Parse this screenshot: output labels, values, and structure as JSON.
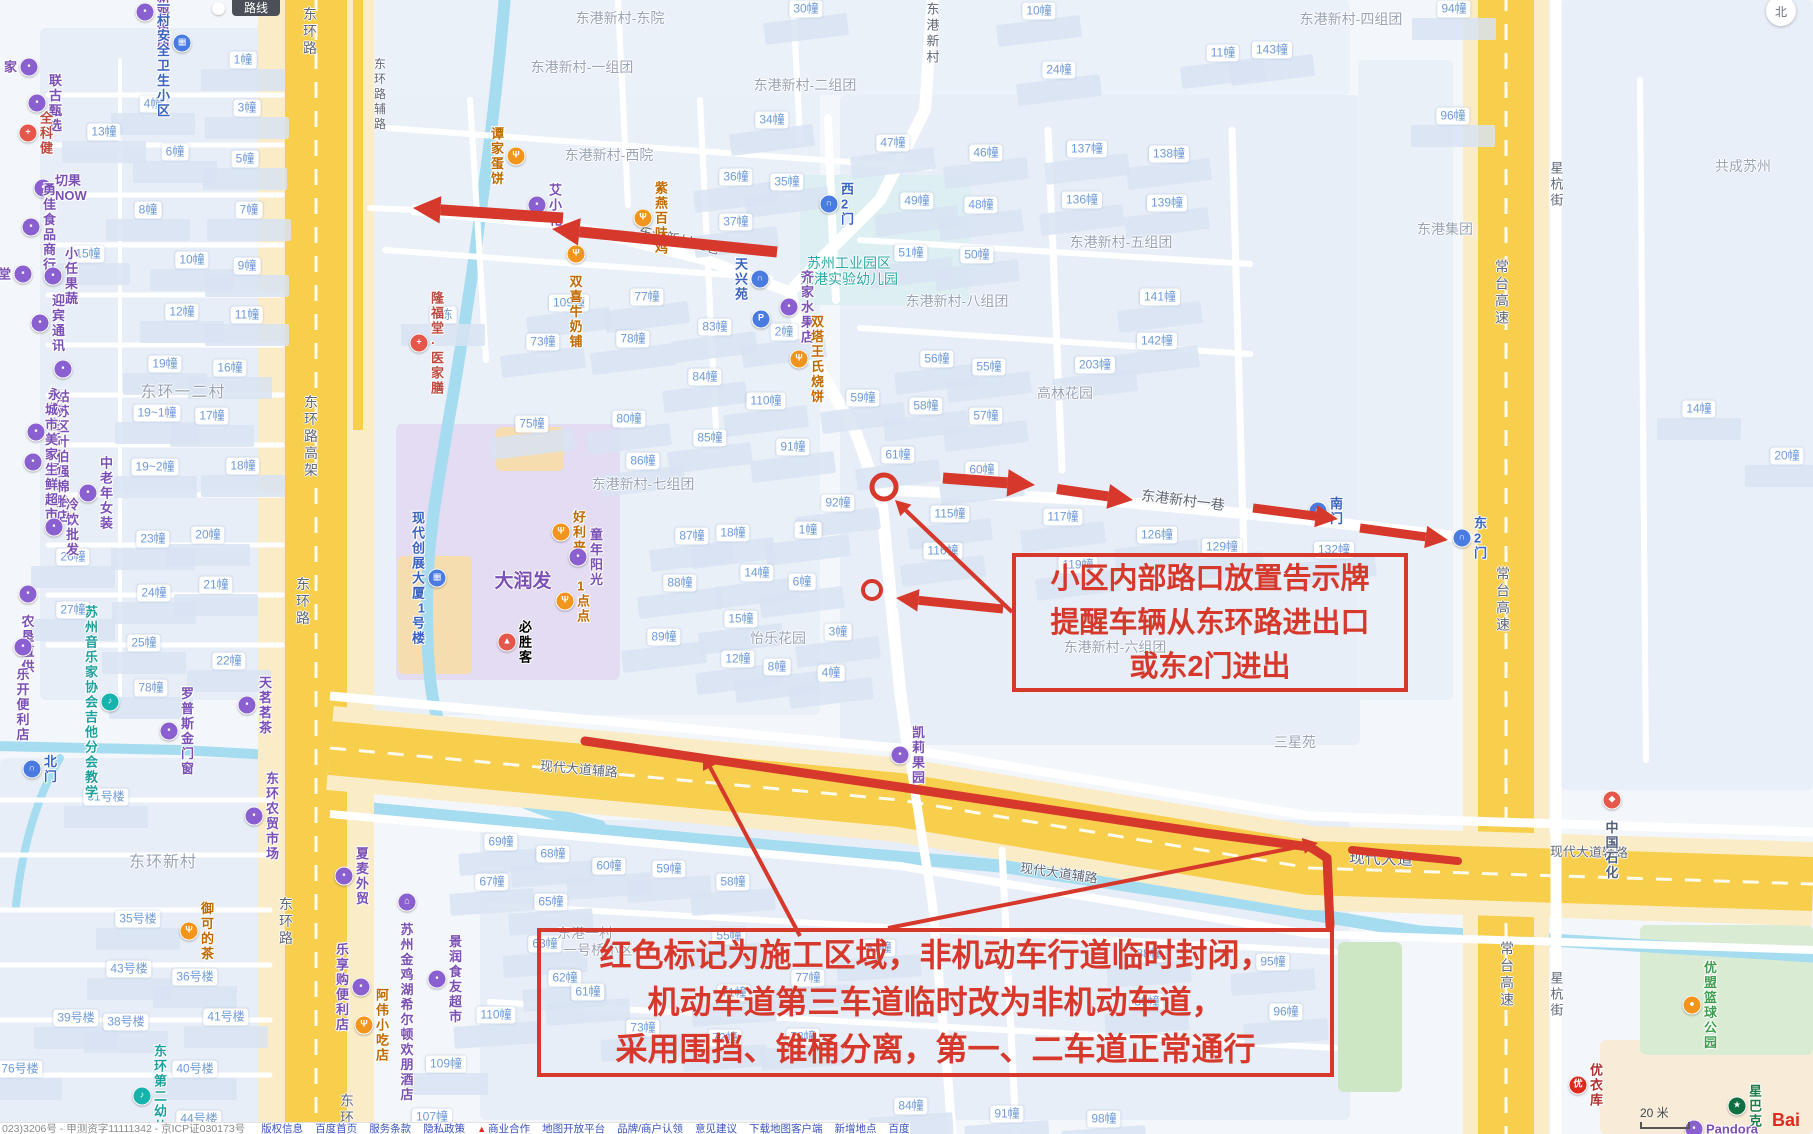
{
  "annotations": {
    "color": "#d6382b",
    "box1": {
      "lines": [
        "小区内部路口放置告示牌",
        "提醒车辆从东环路进出口",
        "或东2门进出"
      ]
    },
    "box2": {
      "lines": [
        "红色标记为施工区域，非机动车行道临时封闭，",
        "机动车道第三车道临时改为非机动车道，",
        "采用围挡、锥桶分离，第一、二车道正常通行"
      ]
    }
  },
  "controls": {
    "route_button": "路线",
    "compass": "北",
    "scale": "20 米",
    "logo": "Bai"
  },
  "footer": {
    "icp": "023)3206号 - 甲测资字11111342 - 京ICP证030173号",
    "links": [
      "版权信息",
      "百度首页",
      "服务条款",
      "隐私政策",
      "商业合作",
      "地图开放平台",
      "品牌/商户认领",
      "意见建议",
      "下载地图客户端",
      "新增地点",
      "百度营销"
    ]
  },
  "map": {
    "buildings": [
      [
        243,
        60,
        "1幢"
      ],
      [
        153,
        104,
        "4幢"
      ],
      [
        247,
        108,
        "3幢"
      ],
      [
        104,
        132,
        "13幢"
      ],
      [
        175,
        152,
        "6幢"
      ],
      [
        245,
        159,
        "5幢"
      ],
      [
        148,
        210,
        "8幢"
      ],
      [
        249,
        210,
        "7幢"
      ],
      [
        88,
        254,
        "15幢"
      ],
      [
        192,
        260,
        "10幢"
      ],
      [
        247,
        266,
        "9幢"
      ],
      [
        182,
        312,
        "12幢"
      ],
      [
        247,
        315,
        "11幢"
      ],
      [
        165,
        364,
        "19幢"
      ],
      [
        230,
        368,
        "16幢"
      ],
      [
        157,
        413,
        "19~1幢"
      ],
      [
        212,
        416,
        "17幢"
      ],
      [
        155,
        467,
        "19~2幢"
      ],
      [
        243,
        466,
        "18幢"
      ],
      [
        153,
        539,
        "23幢"
      ],
      [
        208,
        535,
        "20幢"
      ],
      [
        73,
        557,
        "26幢"
      ],
      [
        216,
        585,
        "21幢"
      ],
      [
        154,
        593,
        "24幢"
      ],
      [
        73,
        610,
        "27幢"
      ],
      [
        144,
        643,
        "25幢"
      ],
      [
        229,
        661,
        "22幢"
      ],
      [
        151,
        688,
        "78幢"
      ],
      [
        106,
        797,
        "31号楼"
      ],
      [
        138,
        919,
        "35号楼"
      ],
      [
        129,
        969,
        "43号楼"
      ],
      [
        195,
        977,
        "36号楼"
      ],
      [
        76,
        1018,
        "39号楼"
      ],
      [
        126,
        1022,
        "38号楼"
      ],
      [
        226,
        1017,
        "41号楼"
      ],
      [
        20,
        1069,
        "76号楼"
      ],
      [
        195,
        1069,
        "40号楼"
      ],
      [
        199,
        1119,
        "44号楼"
      ],
      [
        446,
        1064,
        "109幢"
      ],
      [
        432,
        1117,
        "107幢"
      ],
      [
        443,
        315,
        "1栋"
      ],
      [
        532,
        424,
        "75幢"
      ],
      [
        629,
        419,
        "80幢"
      ],
      [
        710,
        438,
        "85幢"
      ],
      [
        643,
        461,
        "86幢"
      ],
      [
        569,
        303,
        "109幢"
      ],
      [
        543,
        342,
        "73幢"
      ],
      [
        633,
        339,
        "78幢"
      ],
      [
        647,
        297,
        "77幢"
      ],
      [
        715,
        327,
        "83幢"
      ],
      [
        772,
        120,
        "34幢"
      ],
      [
        736,
        177,
        "36幢"
      ],
      [
        787,
        182,
        "35幢"
      ],
      [
        736,
        222,
        "37幢"
      ],
      [
        692,
        536,
        "87幢"
      ],
      [
        733,
        533,
        "18幢"
      ],
      [
        808,
        530,
        "1幢"
      ],
      [
        757,
        573,
        "14幢"
      ],
      [
        802,
        582,
        "6幢"
      ],
      [
        680,
        583,
        "88幢"
      ],
      [
        741,
        619,
        "15幢"
      ],
      [
        664,
        637,
        "89幢"
      ],
      [
        738,
        659,
        "12幢"
      ],
      [
        777,
        667,
        "8幢"
      ],
      [
        831,
        673,
        "4幢"
      ],
      [
        838,
        632,
        "3幢"
      ],
      [
        793,
        447,
        "91幢"
      ],
      [
        838,
        503,
        "92幢"
      ],
      [
        705,
        377,
        "84幢"
      ],
      [
        766,
        401,
        "110幢"
      ],
      [
        784,
        332,
        "2幢"
      ],
      [
        893,
        143,
        "47幢"
      ],
      [
        986,
        153,
        "46幢"
      ],
      [
        917,
        201,
        "49幢"
      ],
      [
        981,
        205,
        "48幢"
      ],
      [
        911,
        253,
        "51幢"
      ],
      [
        977,
        255,
        "50幢"
      ],
      [
        937,
        359,
        "56幢"
      ],
      [
        989,
        367,
        "55幢"
      ],
      [
        863,
        398,
        "59幢"
      ],
      [
        926,
        406,
        "58幢"
      ],
      [
        986,
        416,
        "57幢"
      ],
      [
        898,
        455,
        "61幢"
      ],
      [
        982,
        470,
        "60幢"
      ],
      [
        1087,
        149,
        "137幢"
      ],
      [
        1169,
        154,
        "138幢"
      ],
      [
        1082,
        200,
        "136幢"
      ],
      [
        1167,
        203,
        "139幢"
      ],
      [
        1160,
        297,
        "141幢"
      ],
      [
        1157,
        341,
        "142幢"
      ],
      [
        1095,
        365,
        "203幢"
      ],
      [
        950,
        514,
        "115幢"
      ],
      [
        1063,
        517,
        "117幢"
      ],
      [
        943,
        551,
        "116幢"
      ],
      [
        1157,
        535,
        "126幢"
      ],
      [
        1222,
        547,
        "129幢"
      ],
      [
        1078,
        565,
        "119幢"
      ],
      [
        1334,
        550,
        "132幢"
      ],
      [
        806,
        9,
        "30幢"
      ],
      [
        1039,
        11,
        "10幢"
      ],
      [
        1059,
        70,
        "24幢"
      ],
      [
        1223,
        53,
        "11幢"
      ],
      [
        1272,
        50,
        "143幢"
      ],
      [
        1454,
        9,
        "94幢"
      ],
      [
        1453,
        116,
        "96幢"
      ],
      [
        1699,
        409,
        "14幢"
      ],
      [
        1787,
        456,
        "20幢"
      ],
      [
        501,
        842,
        "69幢"
      ],
      [
        553,
        854,
        "68幢"
      ],
      [
        609,
        866,
        "60幢"
      ],
      [
        669,
        869,
        "59幢"
      ],
      [
        733,
        882,
        "58幢"
      ],
      [
        492,
        882,
        "67幢"
      ],
      [
        551,
        902,
        "65幢"
      ],
      [
        545,
        944,
        "63幢"
      ],
      [
        729,
        936,
        "55幢"
      ],
      [
        879,
        948,
        "81幢"
      ],
      [
        565,
        978,
        "62幢"
      ],
      [
        808,
        978,
        "77幢"
      ],
      [
        588,
        992,
        "61幢"
      ],
      [
        734,
        993,
        "71幢"
      ],
      [
        496,
        1015,
        "110幢"
      ],
      [
        643,
        1028,
        "73幢"
      ],
      [
        725,
        1038,
        "72幢"
      ],
      [
        803,
        1037,
        "78幢"
      ],
      [
        1149,
        954,
        "88幢"
      ],
      [
        1273,
        962,
        "95幢"
      ],
      [
        1147,
        1002,
        "89幢"
      ],
      [
        1286,
        1012,
        "96幢"
      ],
      [
        911,
        1106,
        "84幢"
      ],
      [
        1007,
        1114,
        "91幢"
      ],
      [
        1104,
        1119,
        "98幢"
      ]
    ],
    "areas": [
      [
        609,
        155,
        "东港新村-西院",
        ""
      ],
      [
        620,
        18,
        "东港新村-东院",
        ""
      ],
      [
        582,
        67,
        "东港新村-一组团",
        ""
      ],
      [
        805,
        85,
        "东港新村-二组团",
        ""
      ],
      [
        957,
        301,
        "东港新村-八组团",
        ""
      ],
      [
        1121,
        242,
        "东港新村-五组团",
        ""
      ],
      [
        1351,
        19,
        "东港新村-四组团",
        ""
      ],
      [
        643,
        484,
        "东港新村-七组团",
        ""
      ],
      [
        1115,
        647,
        "东港新村-六组团",
        ""
      ],
      [
        183,
        393,
        "东环一二村",
        "big"
      ],
      [
        163,
        863,
        "东环新村",
        "big"
      ],
      [
        585,
        933,
        "东港一村",
        ""
      ],
      [
        598,
        950,
        "一号桥小区",
        ""
      ],
      [
        778,
        638,
        "怡乐花园",
        ""
      ],
      [
        1065,
        393,
        "高林花园",
        ""
      ],
      [
        1295,
        742,
        "三星苑",
        ""
      ],
      [
        1445,
        229,
        "东港集团",
        ""
      ],
      [
        1743,
        166,
        "共成苏州",
        ""
      ],
      [
        849,
        271,
        "苏州工业园区\n东港实验幼儿园",
        "edu"
      ],
      [
        523,
        582,
        "大润发",
        "mall"
      ]
    ],
    "roadLabels": [
      {
        "x": 310,
        "y": 32,
        "t": "东环路",
        "v": 1
      },
      {
        "x": 380,
        "y": 95,
        "t": "东环路辅路",
        "v": 1,
        "fs": 12
      },
      {
        "x": 311,
        "y": 437,
        "t": "东环路高架",
        "v": 1
      },
      {
        "x": 303,
        "y": 602,
        "t": "东环路",
        "v": 1
      },
      {
        "x": 286,
        "y": 922,
        "t": "东环路",
        "v": 1
      },
      {
        "x": 347,
        "y": 1110,
        "t": "东环",
        "v": 1
      },
      {
        "x": 1502,
        "y": 293,
        "t": "常台高速",
        "v": 1
      },
      {
        "x": 1503,
        "y": 600,
        "t": "常台高速",
        "v": 1
      },
      {
        "x": 1507,
        "y": 975,
        "t": "常台高速",
        "v": 1
      },
      {
        "x": 1556,
        "y": 185,
        "t": "星杭街",
        "v": 1,
        "fs": 13
      },
      {
        "x": 1556,
        "y": 995,
        "t": "星杭街",
        "v": 1,
        "fs": 13
      },
      {
        "x": 932,
        "y": 34,
        "t": "东港新村",
        "v": 1,
        "fs": 13
      },
      {
        "x": 679,
        "y": 240,
        "t": "东港新村二巷",
        "r": 13
      },
      {
        "x": 1183,
        "y": 500,
        "t": "东港新村一巷",
        "r": 7
      },
      {
        "x": 579,
        "y": 768,
        "t": "现代大道辅路",
        "r": 5,
        "fs": 13
      },
      {
        "x": 1059,
        "y": 872,
        "t": "现代大道辅路",
        "r": 8,
        "fs": 13
      },
      {
        "x": 1589,
        "y": 851,
        "t": "现代大道辅路",
        "r": 1,
        "fs": 13
      },
      {
        "x": 1381,
        "y": 857,
        "t": "现代大道",
        "r": 2,
        "fs": 16
      }
    ],
    "pois": [
      {
        "x": 145,
        "y": 12,
        "t": "建新鸡蛋店",
        "c": "shop"
      },
      {
        "x": 182,
        "y": 43,
        "t": "东环一村安全\n卫生小区",
        "c": "gov",
        "s": "left"
      },
      {
        "x": 29,
        "y": 67,
        "t": "家",
        "c": "shop",
        "s": "left"
      },
      {
        "x": 37,
        "y": 103,
        "t": "联古甄选",
        "c": "shop"
      },
      {
        "x": 28,
        "y": 133,
        "t": "全科健",
        "c": "med"
      },
      {
        "x": 43,
        "y": 188,
        "t": "切果NOW",
        "c": "shop"
      },
      {
        "x": 31,
        "y": 227,
        "t": "勇佳食品商行",
        "c": "shop"
      },
      {
        "x": 23,
        "y": 274,
        "t": "堂",
        "c": "shop",
        "s": "left"
      },
      {
        "x": 53,
        "y": 276,
        "t": "小任果蔬",
        "c": "shop"
      },
      {
        "x": 40,
        "y": 323,
        "t": "迎宾通讯",
        "c": "shop"
      },
      {
        "x": 63,
        "y": 369,
        "t": "姑苏区叶\n伯强棉胎店",
        "c": "shop",
        "s": "below"
      },
      {
        "x": 36,
        "y": 432,
        "t": "永林生活广场",
        "c": "shop"
      },
      {
        "x": 33,
        "y": 462,
        "t": "城市美家\n生鲜超市",
        "c": "shop"
      },
      {
        "x": 88,
        "y": 493,
        "t": "中老年女装",
        "c": "shop"
      },
      {
        "x": 54,
        "y": 527,
        "t": "冷饮批发",
        "c": "shop"
      },
      {
        "x": 28,
        "y": 594,
        "t": "农垦直供",
        "c": "shop",
        "s": "below"
      },
      {
        "x": 23,
        "y": 647,
        "t": "乐开便利店",
        "c": "shop",
        "s": "below"
      },
      {
        "x": 110,
        "y": 702,
        "t": "苏州音乐家协会\n吉他分会教学",
        "c": "edu",
        "s": "left"
      },
      {
        "x": 247,
        "y": 705,
        "t": "天茗茗茶",
        "c": "shop"
      },
      {
        "x": 169,
        "y": 731,
        "t": "罗普斯金门窗",
        "c": "shop"
      },
      {
        "x": 32,
        "y": 769,
        "t": "北门",
        "c": "gate"
      },
      {
        "x": 254,
        "y": 816,
        "t": "东环农贸市场",
        "c": "shop"
      },
      {
        "x": 344,
        "y": 876,
        "t": "夏麦外贸",
        "c": "shop"
      },
      {
        "x": 189,
        "y": 931,
        "t": "御可的茶",
        "c": "food"
      },
      {
        "x": 407,
        "y": 902,
        "t": "苏州金鸡湖希尔顿\n欢朋酒店",
        "c": "hotel",
        "s": "below"
      },
      {
        "x": 437,
        "y": 979,
        "t": "景润食友超市",
        "c": "shop"
      },
      {
        "x": 364,
        "y": 1025,
        "t": "阿伟小吃店",
        "c": "food"
      },
      {
        "x": 361,
        "y": 987,
        "t": "乐享购便利店",
        "c": "shop",
        "s": "left"
      },
      {
        "x": 142,
        "y": 1096,
        "t": "东环第二幼儿园",
        "c": "edu"
      },
      {
        "x": 516,
        "y": 156,
        "t": "谭家蛋饼",
        "c": "food",
        "s": "left"
      },
      {
        "x": 537,
        "y": 205,
        "t": "艾小花",
        "c": "shop"
      },
      {
        "x": 643,
        "y": 218,
        "t": "紫燕百味鸡",
        "c": "food"
      },
      {
        "x": 576,
        "y": 254,
        "t": "双喜牛奶铺",
        "c": "food",
        "s": "below"
      },
      {
        "x": 419,
        "y": 343,
        "t": "隆福堂·医家膳",
        "c": "med"
      },
      {
        "x": 760,
        "y": 279,
        "t": "天兴苑",
        "c": "gate",
        "s": "left"
      },
      {
        "x": 761,
        "y": 319,
        "t": "",
        "c": "parking"
      },
      {
        "x": 789,
        "y": 307,
        "t": "齐家水果店",
        "c": "shop"
      },
      {
        "x": 799,
        "y": 359,
        "t": "双塔王氏烧饼",
        "c": "food"
      },
      {
        "x": 829,
        "y": 204,
        "t": "西2门",
        "c": "gate"
      },
      {
        "x": 561,
        "y": 532,
        "t": "好利来",
        "c": "food"
      },
      {
        "x": 578,
        "y": 557,
        "t": "童年阳光",
        "c": "shop"
      },
      {
        "x": 565,
        "y": 601,
        "t": "1点点",
        "c": "food"
      },
      {
        "x": 507,
        "y": 642,
        "t": "必胜客",
        "c": "pizza"
      },
      {
        "x": 437,
        "y": 578,
        "t": "现代创展\n大厦1号楼",
        "c": "build",
        "s": "left"
      },
      {
        "x": 900,
        "y": 755,
        "t": "凯莉果园",
        "c": "shop"
      },
      {
        "x": 1318,
        "y": 511,
        "t": "南门",
        "c": "gate"
      },
      {
        "x": 1462,
        "y": 538,
        "t": "东2门",
        "c": "gate"
      },
      {
        "x": 1612,
        "y": 800,
        "t": "中国石化",
        "c": "gas",
        "s": "below"
      },
      {
        "x": 1692,
        "y": 1005,
        "t": "优盟篮球公园",
        "c": "sport"
      },
      {
        "x": 1578,
        "y": 1085,
        "t": "优衣库",
        "c": "uniqlo"
      },
      {
        "x": 1737,
        "y": 1106,
        "t": "星巴克",
        "c": "coffee"
      },
      {
        "x": 1694,
        "y": 1129,
        "t": "Pandora",
        "c": "shop"
      }
    ]
  }
}
